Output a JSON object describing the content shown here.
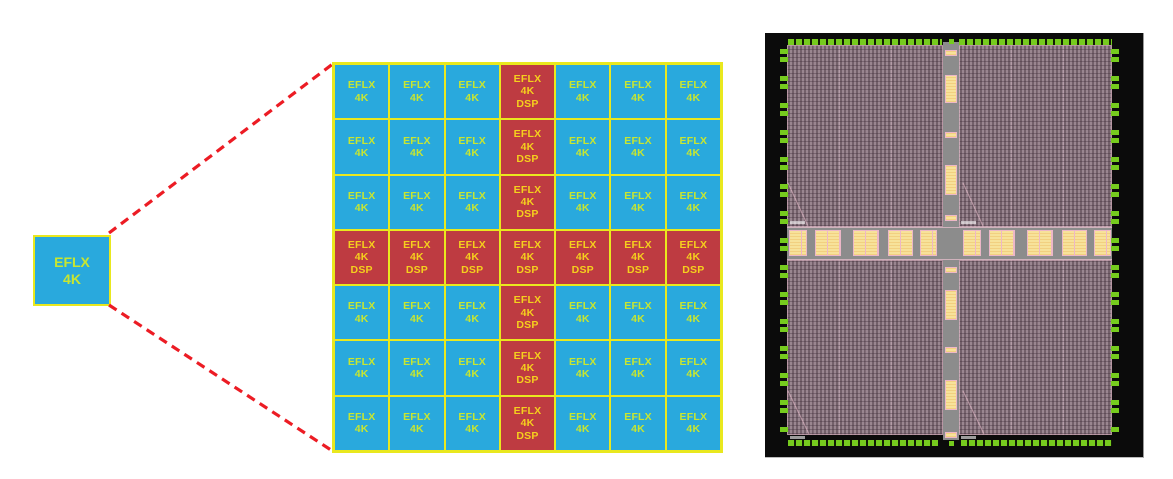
{
  "figure": {
    "left_tile": {
      "line1": "EFLX",
      "line2": "4K"
    },
    "grid": {
      "rows": 7,
      "cols": 7,
      "dsp_row_index": 3,
      "dsp_col_index": 3,
      "logic_label_lines": [
        "EFLX",
        "4K"
      ],
      "dsp_label_lines": [
        "EFLX",
        "4K",
        "DSP"
      ]
    }
  },
  "colors": {
    "tile_blue": "#29A9DD",
    "tile_red": "#BE3B41",
    "tile_border_yellow": "#E9E81E",
    "logic_text": "#C8E630",
    "dsp_text": "#F5D01D",
    "connector_red": "#EC1C24",
    "die_background": "#0B0B0B",
    "die_fabric_mauve": "#9A8690",
    "die_channel_gray": "#8C8C8C",
    "die_block_yellow": "#F7E29A",
    "die_pad_green": "#76CB1E"
  }
}
